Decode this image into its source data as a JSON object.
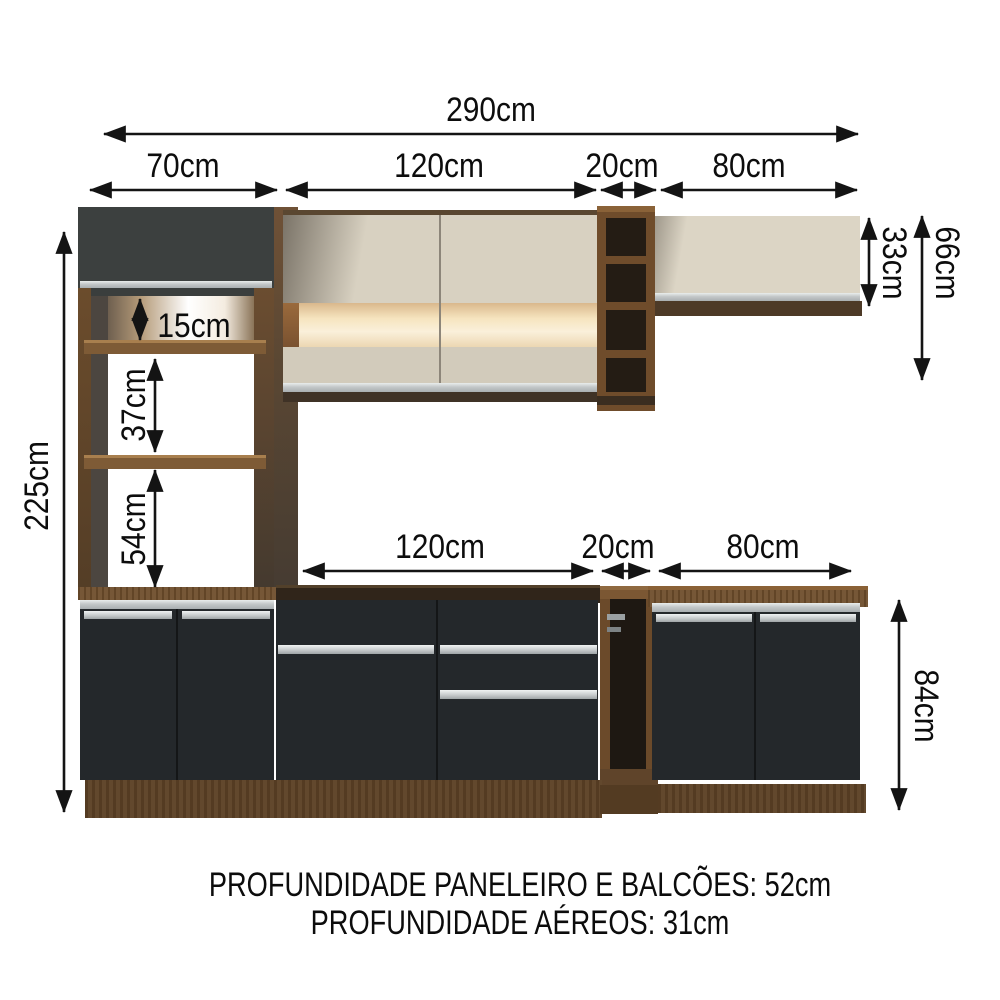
{
  "product_diagram": {
    "dimensions": {
      "total_width": "290cm",
      "top_segments": [
        "70cm",
        "120cm",
        "20cm",
        "80cm"
      ],
      "total_height": "225cm",
      "niche_heights": [
        "15cm",
        "37cm",
        "54cm"
      ],
      "aereo_heights": [
        "33cm",
        "66cm"
      ],
      "counter_segments": [
        "120cm",
        "20cm",
        "80cm"
      ],
      "balcao_height": "84cm"
    },
    "footer": {
      "line1": "PROFUNDIDADE PANELEIRO E BALCÕES: 52cm",
      "line2": "PROFUNDIDADE AÉREOS: 31cm"
    },
    "colors": {
      "wood": "#6f4e2d",
      "plinth_wood": "#5d4226",
      "cream_door": "#d8d1c1",
      "charcoal_door": "#3c403f",
      "black_door": "#24282b",
      "silver_handle": "#c4c8c9",
      "lighted_niche": "#f7e8cc",
      "interior_dark": "#241c14",
      "arrow": "#141414"
    }
  }
}
